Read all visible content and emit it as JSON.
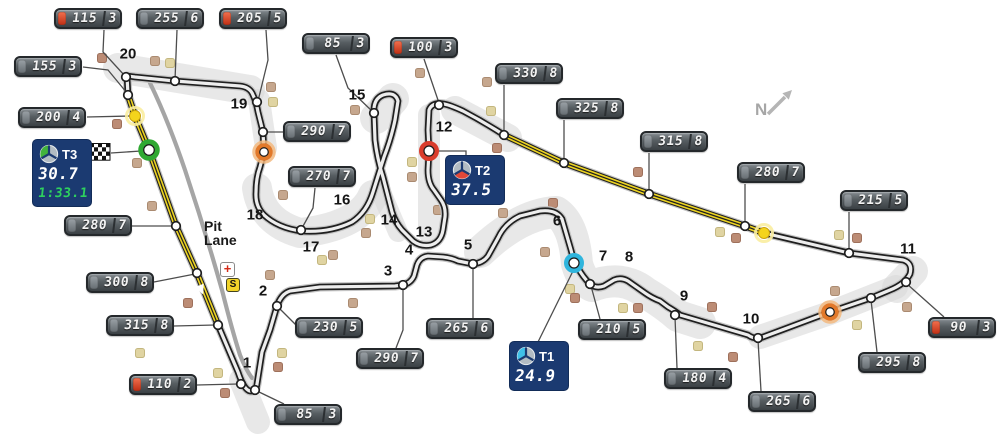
{
  "compass": {
    "label": "N"
  },
  "pit": {
    "line1": "Pit",
    "line2": "Lane",
    "medical_symbol": "+",
    "pit_entry_symbol": "S"
  },
  "sector_boxes": [
    {
      "id": "t3",
      "label": "T3",
      "value": "30.7",
      "lap": "1:33.1",
      "color": "#41b33c",
      "wedge": "left",
      "line": [
        [
          111,
          153
        ],
        [
          141,
          151
        ]
      ]
    },
    {
      "id": "t2",
      "label": "T2",
      "value": "37.5",
      "lap": "",
      "color": "#e14838",
      "wedge": "bottom",
      "line": [
        [
          437,
          151
        ],
        [
          466,
          151
        ],
        [
          466,
          157
        ]
      ]
    },
    {
      "id": "t1",
      "label": "T1",
      "value": "24.9",
      "lap": "",
      "color": "#3fc0e8",
      "wedge": "left",
      "line": [
        [
          538,
          342
        ],
        [
          573,
          271
        ]
      ]
    }
  ],
  "signs": [
    {
      "speed": "115",
      "gear": "3",
      "red": true,
      "x": 54,
      "y": 8,
      "line": [
        [
          104,
          30
        ],
        [
          103,
          52
        ],
        [
          125,
          76
        ]
      ]
    },
    {
      "speed": "255",
      "gear": "6",
      "red": false,
      "x": 136,
      "y": 8,
      "line": [
        [
          177,
          30
        ],
        [
          175,
          80
        ]
      ]
    },
    {
      "speed": "205",
      "gear": "5",
      "red": true,
      "x": 219,
      "y": 8,
      "line": [
        [
          266,
          30
        ],
        [
          268,
          60
        ],
        [
          258,
          101
        ]
      ]
    },
    {
      "speed": "85",
      "gear": "3",
      "red": false,
      "x": 302,
      "y": 33,
      "line": [
        [
          336,
          55
        ],
        [
          348,
          88
        ],
        [
          373,
          112
        ]
      ]
    },
    {
      "speed": "100",
      "gear": "3",
      "red": true,
      "x": 390,
      "y": 37,
      "line": [
        [
          424,
          59
        ],
        [
          439,
          103
        ]
      ]
    },
    {
      "speed": "155",
      "gear": "3",
      "red": false,
      "x": 14,
      "y": 56,
      "line": [
        [
          83,
          67
        ],
        [
          108,
          70
        ],
        [
          127,
          93
        ]
      ]
    },
    {
      "speed": "200",
      "gear": "4",
      "red": false,
      "x": 18,
      "y": 107,
      "line": [
        [
          87,
          117
        ],
        [
          130,
          116
        ]
      ]
    },
    {
      "speed": "330",
      "gear": "8",
      "red": false,
      "x": 495,
      "y": 63,
      "line": [
        [
          504,
          85
        ],
        [
          504,
          133
        ]
      ]
    },
    {
      "speed": "325",
      "gear": "8",
      "red": false,
      "x": 556,
      "y": 98,
      "line": [
        [
          564,
          120
        ],
        [
          564,
          161
        ]
      ]
    },
    {
      "speed": "315",
      "gear": "8",
      "red": false,
      "x": 640,
      "y": 131,
      "line": [
        [
          649,
          153
        ],
        [
          649,
          192
        ]
      ]
    },
    {
      "speed": "290",
      "gear": "7",
      "red": false,
      "x": 283,
      "y": 121,
      "line": [
        [
          283,
          132
        ],
        [
          266,
          132
        ]
      ]
    },
    {
      "speed": "270",
      "gear": "7",
      "red": false,
      "x": 288,
      "y": 166,
      "line": [
        [
          315,
          188
        ],
        [
          313,
          208
        ],
        [
          302,
          228
        ]
      ]
    },
    {
      "speed": "280",
      "gear": "7",
      "red": false,
      "x": 737,
      "y": 162,
      "line": [
        [
          745,
          184
        ],
        [
          745,
          224
        ]
      ]
    },
    {
      "speed": "215",
      "gear": "5",
      "red": false,
      "x": 840,
      "y": 190,
      "line": [
        [
          849,
          212
        ],
        [
          849,
          251
        ]
      ]
    },
    {
      "speed": "280",
      "gear": "7",
      "red": false,
      "x": 64,
      "y": 215,
      "line": [
        [
          132,
          226
        ],
        [
          173,
          226
        ]
      ]
    },
    {
      "speed": "300",
      "gear": "8",
      "red": false,
      "x": 86,
      "y": 272,
      "line": [
        [
          154,
          282
        ],
        [
          195,
          274
        ]
      ]
    },
    {
      "speed": "315",
      "gear": "8",
      "red": false,
      "x": 106,
      "y": 315,
      "line": [
        [
          174,
          326
        ],
        [
          215,
          325
        ]
      ]
    },
    {
      "speed": "110",
      "gear": "2",
      "red": true,
      "x": 129,
      "y": 374,
      "line": [
        [
          197,
          385
        ],
        [
          238,
          384
        ]
      ]
    },
    {
      "speed": "230",
      "gear": "5",
      "red": false,
      "x": 295,
      "y": 317,
      "line": [
        [
          297,
          326
        ],
        [
          279,
          308
        ]
      ]
    },
    {
      "speed": "290",
      "gear": "7",
      "red": false,
      "x": 356,
      "y": 348,
      "line": [
        [
          396,
          348
        ],
        [
          403,
          330
        ],
        [
          403,
          287
        ]
      ]
    },
    {
      "speed": "265",
      "gear": "6",
      "red": false,
      "x": 426,
      "y": 318,
      "line": [
        [
          473,
          318
        ],
        [
          473,
          266
        ]
      ]
    },
    {
      "speed": "85",
      "gear": "3",
      "red": false,
      "x": 274,
      "y": 404,
      "line": [
        [
          284,
          404
        ],
        [
          257,
          391
        ]
      ]
    },
    {
      "speed": "210",
      "gear": "5",
      "red": false,
      "x": 578,
      "y": 319,
      "line": [
        [
          600,
          319
        ],
        [
          591,
          286
        ]
      ]
    },
    {
      "speed": "180",
      "gear": "4",
      "red": false,
      "x": 664,
      "y": 368,
      "line": [
        [
          677,
          368
        ],
        [
          675,
          317
        ]
      ]
    },
    {
      "speed": "265",
      "gear": "6",
      "red": false,
      "x": 748,
      "y": 391,
      "line": [
        [
          761,
          391
        ],
        [
          758,
          340
        ]
      ]
    },
    {
      "speed": "295",
      "gear": "8",
      "red": false,
      "x": 858,
      "y": 352,
      "line": [
        [
          877,
          352
        ],
        [
          871,
          300
        ]
      ]
    },
    {
      "speed": "90",
      "gear": "3",
      "red": true,
      "x": 928,
      "y": 317,
      "line": [
        [
          944,
          317
        ],
        [
          907,
          284
        ]
      ]
    }
  ],
  "turns": [
    {
      "n": "1",
      "x": 247,
      "y": 363
    },
    {
      "n": "2",
      "x": 263,
      "y": 291
    },
    {
      "n": "3",
      "x": 388,
      "y": 271
    },
    {
      "n": "4",
      "x": 409,
      "y": 250
    },
    {
      "n": "5",
      "x": 468,
      "y": 245
    },
    {
      "n": "6",
      "x": 557,
      "y": 221
    },
    {
      "n": "7",
      "x": 603,
      "y": 256
    },
    {
      "n": "8",
      "x": 629,
      "y": 257
    },
    {
      "n": "9",
      "x": 684,
      "y": 296
    },
    {
      "n": "10",
      "x": 751,
      "y": 319
    },
    {
      "n": "11",
      "x": 908,
      "y": 249
    },
    {
      "n": "12",
      "x": 444,
      "y": 127
    },
    {
      "n": "13",
      "x": 424,
      "y": 232
    },
    {
      "n": "14",
      "x": 389,
      "y": 220
    },
    {
      "n": "15",
      "x": 357,
      "y": 95
    },
    {
      "n": "16",
      "x": 342,
      "y": 200
    },
    {
      "n": "17",
      "x": 311,
      "y": 247
    },
    {
      "n": "18",
      "x": 255,
      "y": 215
    },
    {
      "n": "19",
      "x": 239,
      "y": 104
    },
    {
      "n": "20",
      "x": 128,
      "y": 54
    }
  ],
  "markers": [
    {
      "kind": "ring",
      "name": "start-finish-marker",
      "x": 149,
      "y": 150,
      "r": 8,
      "w": 5.5,
      "color": "#2fa832"
    },
    {
      "kind": "ring",
      "name": "sector2-end-marker",
      "x": 429,
      "y": 151,
      "r": 7.5,
      "w": 5,
      "color": "#d93b2b"
    },
    {
      "kind": "ring",
      "name": "sector1-end-marker",
      "x": 574,
      "y": 263,
      "r": 7.5,
      "w": 5,
      "color": "#2fb5dd"
    },
    {
      "kind": "ringhalo",
      "name": "drs-detection-marker-1",
      "x": 264,
      "y": 152,
      "r": 6.5,
      "w": 4.5,
      "color": "#e2792a",
      "halo": "#f2b87f"
    },
    {
      "kind": "ringhalo",
      "name": "drs-detection-marker-2",
      "x": 830,
      "y": 312,
      "r": 6.5,
      "w": 4.5,
      "color": "#e2792a",
      "halo": "#f2b87f"
    },
    {
      "kind": "dothalo",
      "name": "drs-activation-marker-1",
      "x": 135,
      "y": 116,
      "r": 5.5,
      "color": "#f4d41c",
      "halo": "#f9eda0"
    },
    {
      "kind": "dothalo",
      "name": "drs-activation-marker-2",
      "x": 764,
      "y": 233,
      "r": 5.5,
      "color": "#f4d41c",
      "halo": "#f9eda0"
    }
  ],
  "nodes": [
    [
      126,
      77
    ],
    [
      175,
      81
    ],
    [
      257,
      102
    ],
    [
      128,
      95
    ],
    [
      263,
      132
    ],
    [
      439,
      105
    ],
    [
      504,
      135
    ],
    [
      564,
      163
    ],
    [
      649,
      194
    ],
    [
      745,
      226
    ],
    [
      849,
      253
    ],
    [
      906,
      282
    ],
    [
      871,
      298
    ],
    [
      758,
      338
    ],
    [
      675,
      315
    ],
    [
      590,
      284
    ],
    [
      473,
      264
    ],
    [
      403,
      285
    ],
    [
      277,
      306
    ],
    [
      241,
      384
    ],
    [
      255,
      390
    ],
    [
      218,
      325
    ],
    [
      197,
      273
    ],
    [
      176,
      226
    ],
    [
      301,
      230
    ],
    [
      374,
      113
    ]
  ],
  "squares": [
    [
      102,
      58,
      "r"
    ],
    [
      155,
      61,
      "t"
    ],
    [
      170,
      63,
      "k"
    ],
    [
      271,
      87,
      "t"
    ],
    [
      273,
      102,
      "k"
    ],
    [
      117,
      124,
      "r"
    ],
    [
      137,
      163,
      "t"
    ],
    [
      152,
      206,
      "t"
    ],
    [
      188,
      303,
      "r"
    ],
    [
      140,
      353,
      "k"
    ],
    [
      152,
      390,
      "r"
    ],
    [
      282,
      353,
      "k"
    ],
    [
      278,
      367,
      "r"
    ],
    [
      218,
      373,
      "k"
    ],
    [
      225,
      393,
      "r"
    ],
    [
      283,
      195,
      "t"
    ],
    [
      370,
      219,
      "k"
    ],
    [
      366,
      233,
      "t"
    ],
    [
      333,
      255,
      "t"
    ],
    [
      322,
      260,
      "k"
    ],
    [
      270,
      275,
      "t"
    ],
    [
      353,
      303,
      "t"
    ],
    [
      438,
      210,
      "t"
    ],
    [
      355,
      110,
      "t"
    ],
    [
      412,
      162,
      "k"
    ],
    [
      412,
      177,
      "t"
    ],
    [
      420,
      73,
      "t"
    ],
    [
      487,
      82,
      "t"
    ],
    [
      491,
      111,
      "k"
    ],
    [
      497,
      148,
      "r"
    ],
    [
      553,
      203,
      "r"
    ],
    [
      638,
      172,
      "r"
    ],
    [
      720,
      232,
      "k"
    ],
    [
      736,
      238,
      "r"
    ],
    [
      839,
      235,
      "k"
    ],
    [
      857,
      238,
      "r"
    ],
    [
      835,
      291,
      "t"
    ],
    [
      857,
      325,
      "k"
    ],
    [
      907,
      307,
      "t"
    ],
    [
      503,
      213,
      "t"
    ],
    [
      545,
      252,
      "t"
    ],
    [
      570,
      289,
      "k"
    ],
    [
      575,
      298,
      "r"
    ],
    [
      623,
      308,
      "k"
    ],
    [
      638,
      308,
      "r"
    ],
    [
      712,
      307,
      "r"
    ],
    [
      698,
      346,
      "k"
    ],
    [
      733,
      357,
      "r"
    ],
    [
      383,
      155,
      "k"
    ]
  ],
  "square_colors": {
    "t": {
      "f": "#c6a78e",
      "s": "#aa8a70"
    },
    "r": {
      "f": "#bc8c75",
      "s": "#9e705b"
    },
    "k": {
      "f": "#e0d4a2",
      "s": "#c3b67e"
    }
  },
  "track": {
    "main": "M127,76 L128,95 L135,116 L149,150 L176,226 L197,273 L218,325 L238,372 Q244,390 250,391 Q256,392 257,384 L262,352 L270,330 L277,306 Q281,294 290,291 L320,287 L395,286 L403,285 Q411,283 414,276 L417,265 Q420,257 428,256 L443,257 Q452,258 458,261 L473,264 Q483,263 488,256 L498,238 Q505,223 520,216 L540,211 Q556,209 562,219 L571,250 Q574,262 578,268 Q583,277 590,284 Q596,289 604,286 L614,280 Q621,277 628,281 L645,293 Q652,298 660,301 L668,307 Q675,311 680,315 L748,335 Q755,340 763,337 L830,312 L871,298 L890,290 Q905,284 910,274 Q913,263 903,260 L849,253 L764,233 L745,226 L649,194 L564,163 L504,135 Q484,122 463,111 Q450,105 444,104 Q432,102 429,110 L428,130 L429,151 L428,170 Q428,183 434,190 L441,200 Q446,207 445,217 L443,230 Q441,242 431,245 Q421,247 413,241 L402,230 Q395,222 392,212 L383,177 Q377,158 375,140 L374,113 Q373,99 383,95 Q395,91 398,101 L395,120 Q391,139 384,157 L373,192 Q367,212 352,222 Q330,233 301,231 Q278,228 264,215 Q255,206 256,192 Q256,178 260,167 L264,152 L263,132 L258,112 Q256,101 253,95 Q250,87 240,86 L175,81 L135,77 Q128,76 127,76 Z",
    "drs": [
      "M128,95 L135,116 L149,150 L176,226 L197,273 L218,325",
      "M504,135 L564,163 L649,194 L745,226 L764,233"
    ],
    "pit_lane": "M150,83 Q168,120 185,170 Q205,230 222,290 Q232,330 240,355 Q246,370 252,378",
    "runoff": [
      {
        "d": "M118,68 L250,90",
        "w": 30
      },
      {
        "d": "M259,100 L266,148",
        "w": 22
      },
      {
        "d": "M373,195 Q360,226 300,233 Q262,222 257,188",
        "w": 30
      },
      {
        "d": "M376,118 L393,99",
        "w": 32
      },
      {
        "d": "M429,115 L429,232",
        "w": 22
      },
      {
        "d": "M455,110 L508,138",
        "w": 28
      },
      {
        "d": "M480,252 Q520,214 556,212 Q574,224 577,264 Q582,281 592,286 Q622,274 646,293 Q666,305 678,316 L700,323",
        "w": 32
      },
      {
        "d": "M760,337 L830,313 L896,287",
        "w": 24
      },
      {
        "d": "M897,288 L913,271",
        "w": 30
      },
      {
        "d": "M241,380 L258,422",
        "w": 24
      },
      {
        "d": "M398,232 L381,192",
        "w": 20
      }
    ],
    "arrow": {
      "x": 201,
      "y": 289,
      "angle": 68
    }
  }
}
